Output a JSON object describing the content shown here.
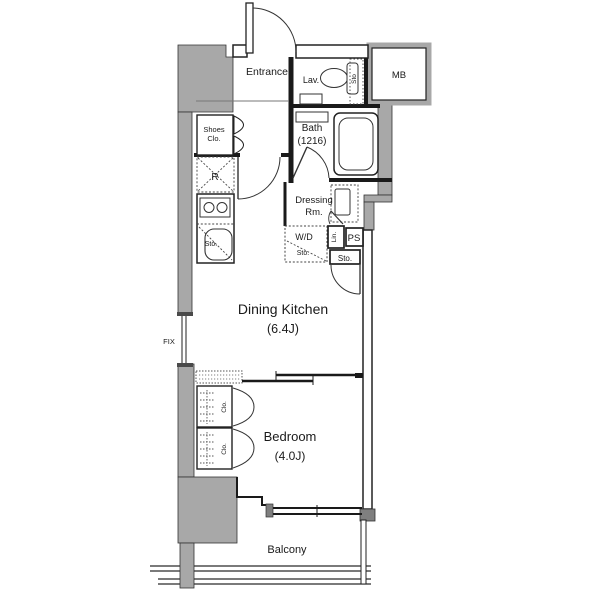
{
  "plan": {
    "colors": {
      "wall_gray": "#a8a8a8",
      "wall_dark": "#7f7f7f",
      "line": "#1a1a1a",
      "background": "#ffffff"
    },
    "rooms": {
      "entrance": {
        "label": "Entrance"
      },
      "lavatory": {
        "label": "Lav."
      },
      "lavatory_storage": {
        "label": "Sto"
      },
      "meter_box": {
        "label": "MB"
      },
      "bath": {
        "label": "Bath",
        "size": "(1216)"
      },
      "shoes_closet": {
        "line1": "Shoes",
        "line2": "Clo."
      },
      "refrigerator": {
        "label": "R"
      },
      "kitchen_storage": {
        "label": "Sto."
      },
      "dressing_room": {
        "line1": "Dressing",
        "line2": "Rm."
      },
      "washer_dryer": {
        "label": "W/D",
        "storage": "Sto."
      },
      "linen": {
        "label": "Lin."
      },
      "pipe_space": {
        "label": "PS"
      },
      "hall_storage": {
        "label": "Sto."
      },
      "dining_kitchen": {
        "label": "Dining Kitchen",
        "size": "(6.4J)"
      },
      "fix_window": {
        "label": "FIX"
      },
      "bedroom": {
        "label": "Bedroom",
        "size": "(4.0J)"
      },
      "closet_upper": {
        "label": "Clo."
      },
      "closet_lower": {
        "label": "Clo."
      },
      "balcony": {
        "label": "Balcony"
      }
    }
  }
}
